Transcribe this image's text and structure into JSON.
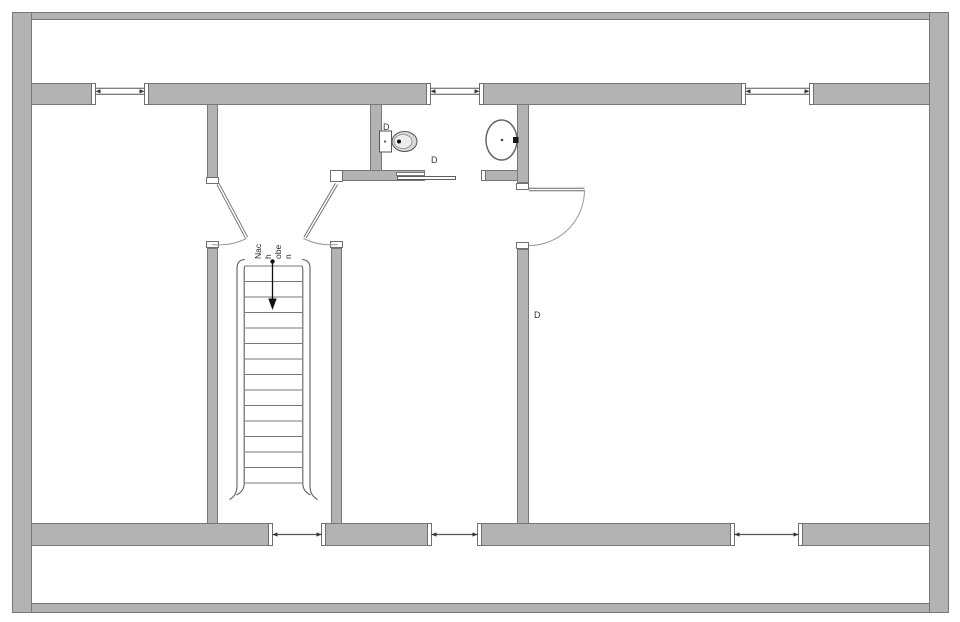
{
  "plan": {
    "stair_label_full": "Nach oben",
    "stair_label_lines": [
      "Nac",
      "h",
      "obe",
      "n"
    ],
    "door_labels": {
      "bathroom_top": "D",
      "bathroom_sliding": "D",
      "bedroom": "D"
    },
    "icons": {
      "toilet": "toilet-plan-symbol",
      "sink": "sink-plan-symbol",
      "stairs": "staircase-up-symbol",
      "arrow": "stair-direction-arrow"
    }
  },
  "colors": {
    "background": "#ffffff",
    "wall_fill": "#b3b3b3",
    "wall_border": "#787878",
    "line": "#555555",
    "annotation": "#333333"
  }
}
